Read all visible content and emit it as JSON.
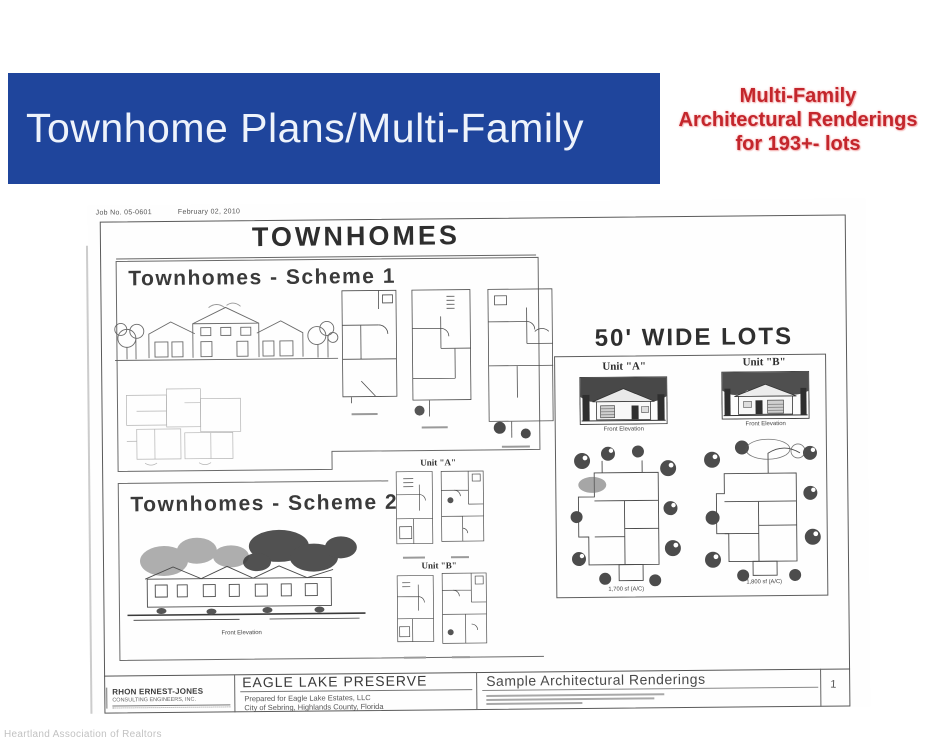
{
  "colors": {
    "banner_bg": "#1f459c",
    "callout_red": "#c3262c"
  },
  "banner": {
    "title": "Townhome Plans/Multi-Family"
  },
  "callout": {
    "line1": "Multi-Family",
    "line2": "Architectural Renderings",
    "line3": "for 193+- lots"
  },
  "sheet": {
    "job_no": "Job No. 05-0601",
    "date": "February 02, 2010",
    "main_title": "TOWNHOMES",
    "scheme1_title": "Townhomes - Scheme 1",
    "scheme2_title": "Townhomes - Scheme 2",
    "scheme2_elevation_caption": "Front Elevation",
    "mid_units": {
      "unit_a": "Unit \"A\"",
      "unit_b": "Unit \"B\""
    },
    "wide_lots": {
      "title": "50' WIDE LOTS",
      "unit_a": "Unit \"A\"",
      "unit_b": "Unit \"B\"",
      "front_elevation_a": "Front Elevation",
      "front_elevation_b": "Front Elevation",
      "area_a": "1,700 sf (A/C)",
      "area_b": "1,800 sf (A/C)"
    },
    "titleblock": {
      "firm": "RHON ERNEST-JONES",
      "firm_sub": "CONSULTING ENGINEERS, INC.",
      "project": "EAGLE LAKE PRESERVE",
      "prepared": "Prepared for Eagle Lake Estates, LLC",
      "city": "City of Sebring, Highlands County, Florida",
      "sheet_name": "Sample Architectural Renderings",
      "page": "1"
    }
  },
  "page": {
    "watermark": "Heartland Association of Realtors"
  }
}
